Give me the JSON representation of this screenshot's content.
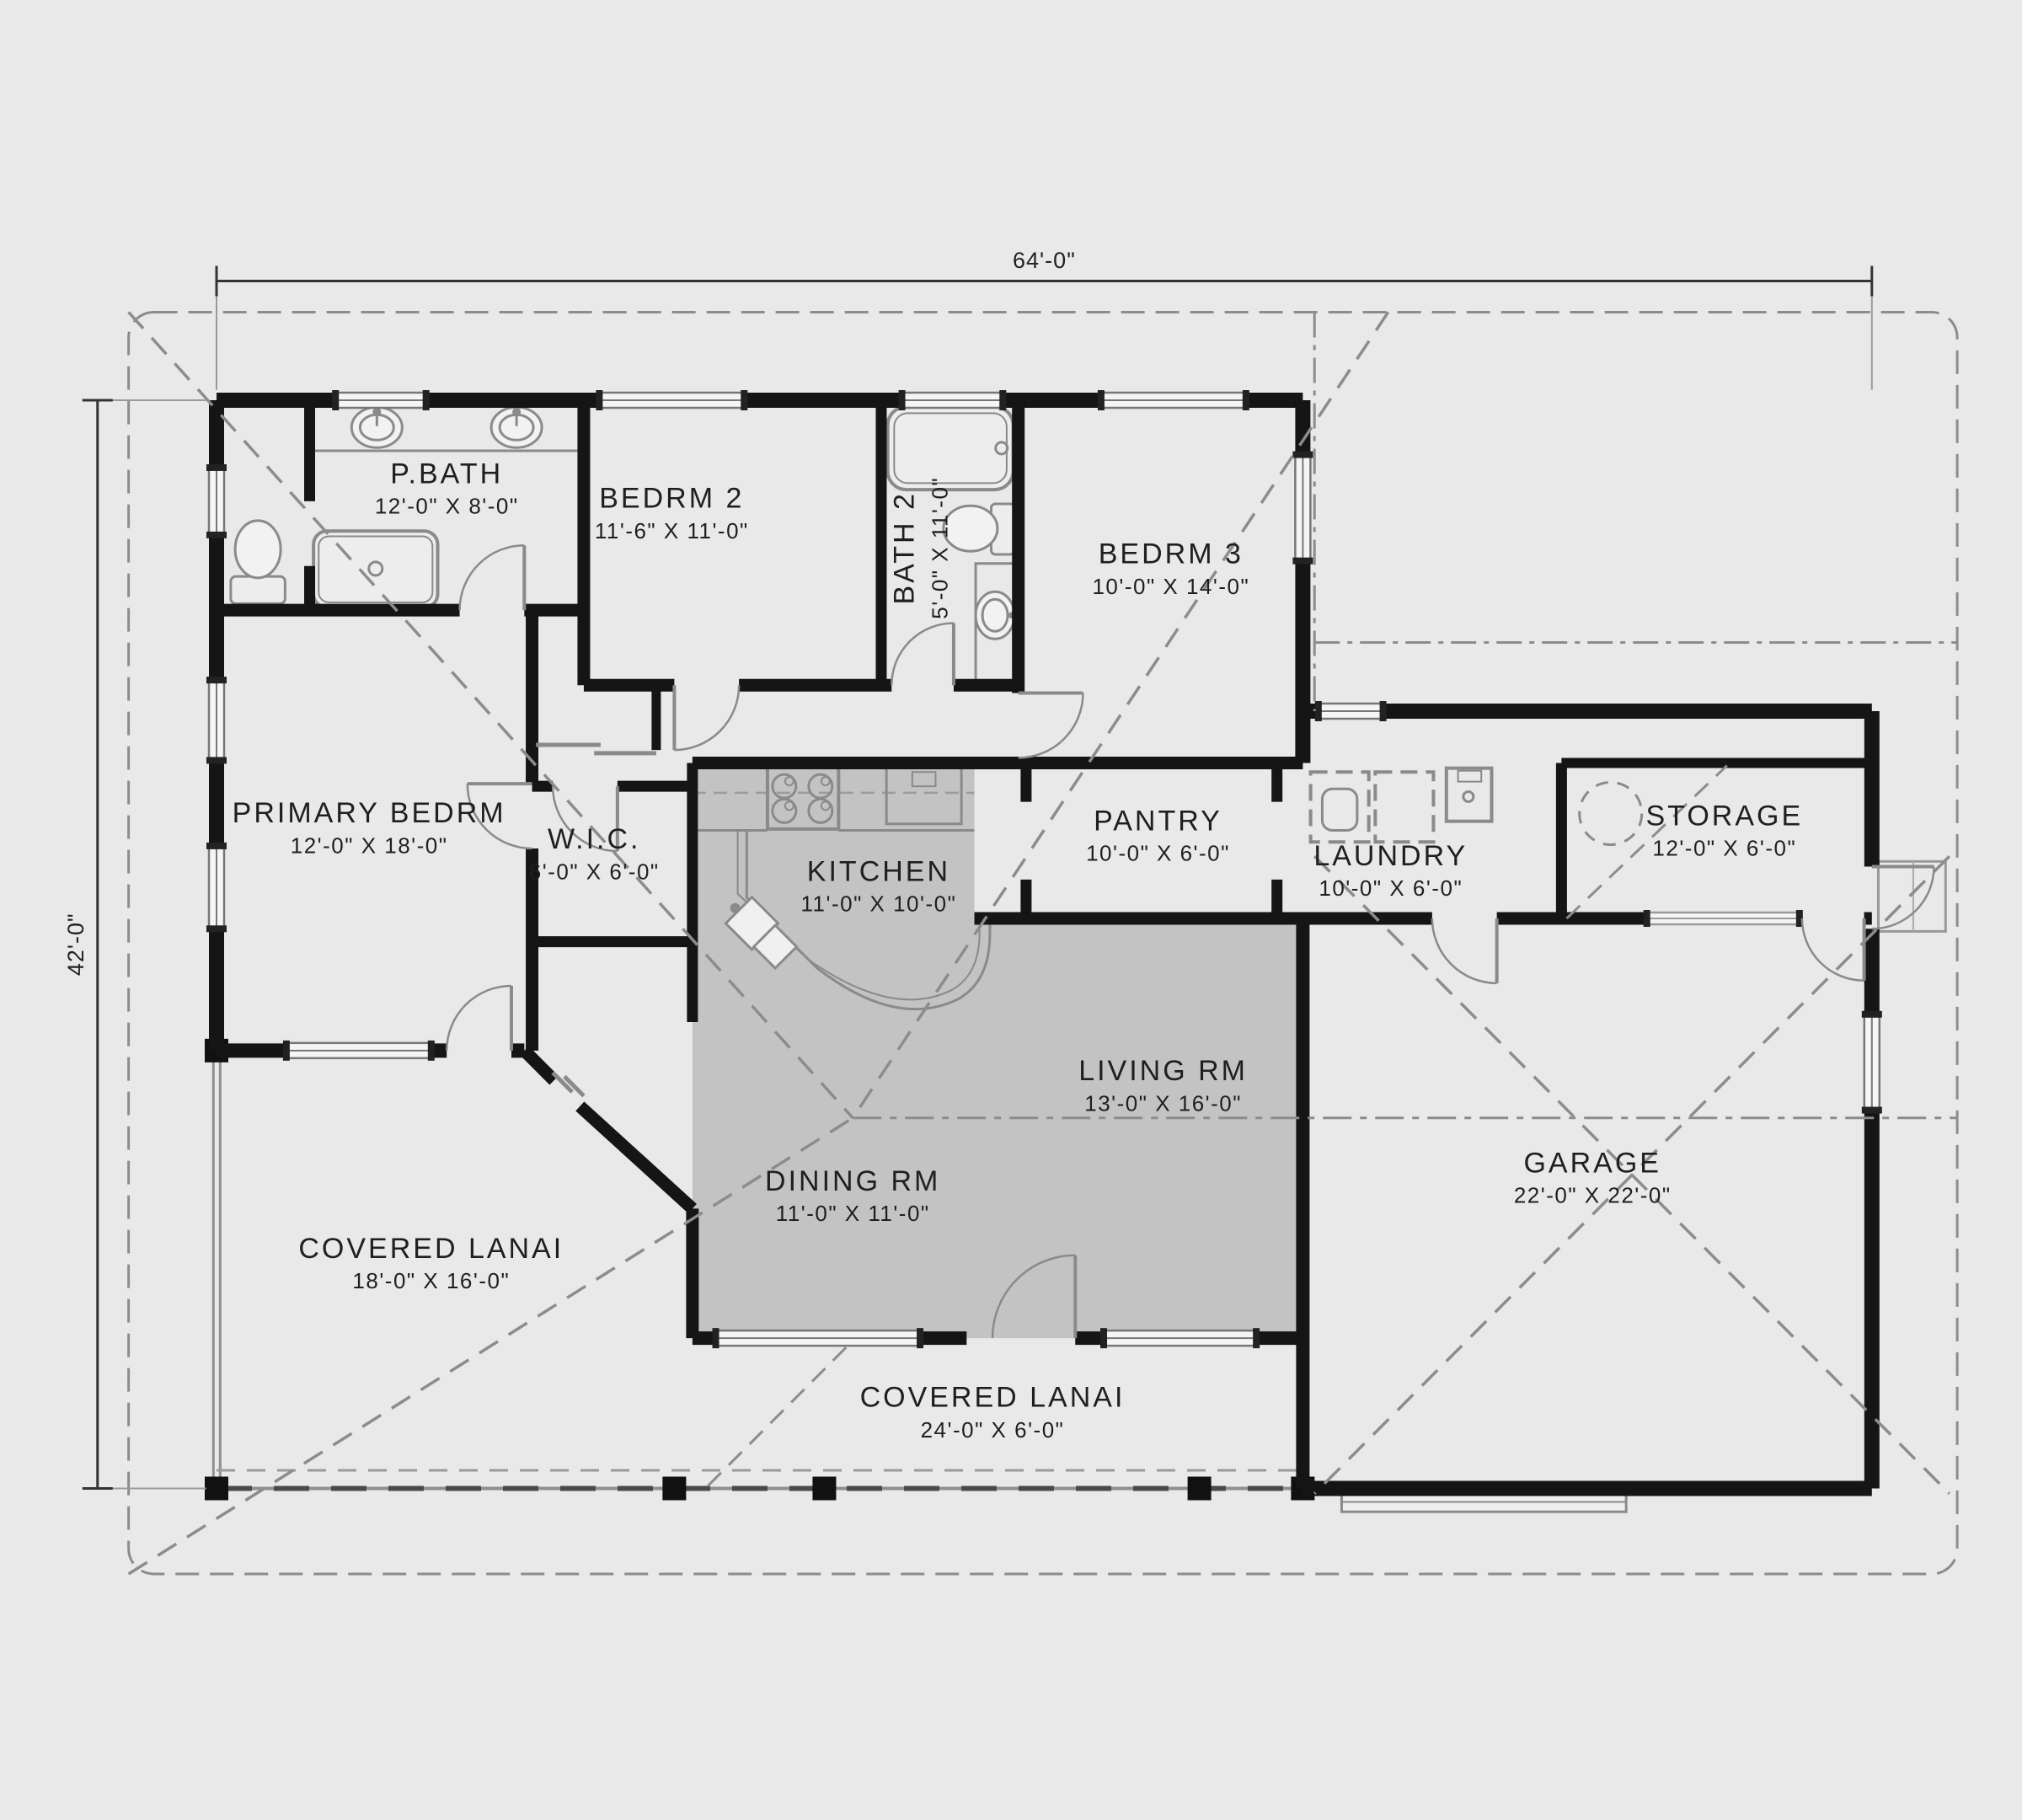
{
  "plan_title": "Single-story house floor plan",
  "dimension_labels": {
    "top": "64'-0\"",
    "left": "42'-0\""
  },
  "rooms": [
    {
      "id": "pbath",
      "name": "P.BATH",
      "size": "12'-0\" X 8'-0\""
    },
    {
      "id": "bedrm2",
      "name": "BEDRM 2",
      "size": "11'-6\" X 11'-0\""
    },
    {
      "id": "bath2",
      "name": "BATH 2",
      "size": "5'-0\" X 11'-0\""
    },
    {
      "id": "bedrm3",
      "name": "BEDRM 3",
      "size": "10'-0\" X 14'-0\""
    },
    {
      "id": "primary",
      "name": "PRIMARY BEDRM",
      "size": "12'-0\" X 18'-0\""
    },
    {
      "id": "wic",
      "name": "W.I.C.",
      "size": "6'-0\" X 6'-0\""
    },
    {
      "id": "kitchen",
      "name": "KITCHEN",
      "size": "11'-0\" X 10'-0\""
    },
    {
      "id": "pantry",
      "name": "PANTRY",
      "size": "10'-0\" X 6'-0\""
    },
    {
      "id": "laundry",
      "name": "LAUNDRY",
      "size": "10'-0\" X 6'-0\""
    },
    {
      "id": "storage",
      "name": "STORAGE",
      "size": "12'-0\" X 6'-0\""
    },
    {
      "id": "living",
      "name": "LIVING RM",
      "size": "13'-0\" X 16'-0\""
    },
    {
      "id": "dining",
      "name": "DINING RM",
      "size": "11'-0\" X 11'-0\""
    },
    {
      "id": "lanai_left",
      "name": "COVERED LANAI",
      "size": "18'-0\" X 16'-0\""
    },
    {
      "id": "garage",
      "name": "GARAGE",
      "size": "22'-0\" X 22'-0\""
    },
    {
      "id": "lanai_bottom",
      "name": "COVERED LANAI",
      "size": "24'-0\" X 6'-0\""
    }
  ],
  "colors": {
    "background": "#e9e9e9",
    "walls": "#151515",
    "fixtures": "#8a8a8a",
    "roof_lines": "#8c8c8c",
    "shaded_floor": "#bcbcbc",
    "text": "#1f1f1f"
  }
}
